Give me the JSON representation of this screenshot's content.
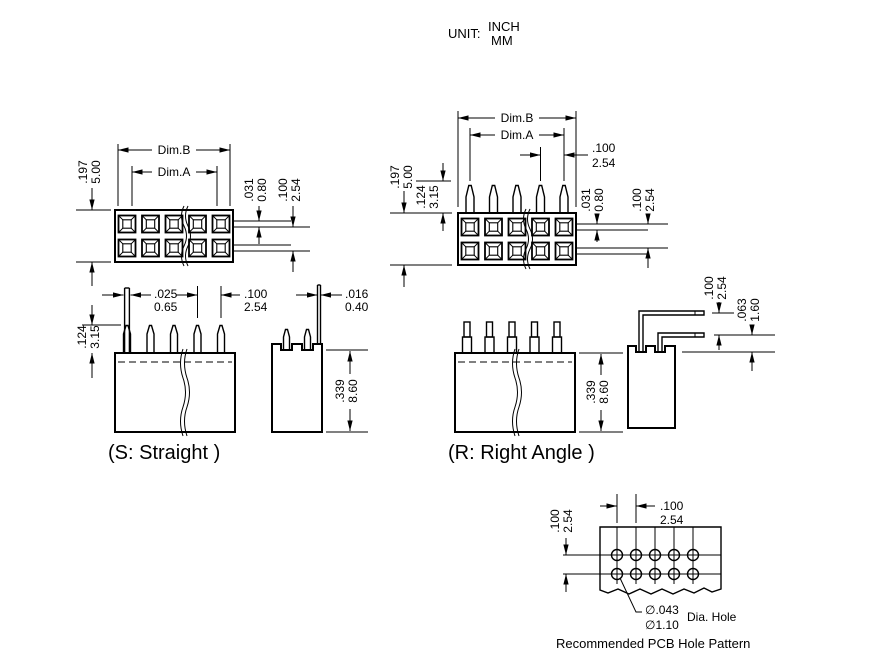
{
  "unit": {
    "label": "UNIT:",
    "inch": "INCH",
    "mm": "MM"
  },
  "dims": {
    "dimB": "Dim.B",
    "dimA": "Dim.A",
    "d197": {
      "inch": ".197",
      "mm": "5.00"
    },
    "d124": {
      "inch": ".124",
      "mm": "3.15"
    },
    "d031": {
      "inch": ".031",
      "mm": "0.80"
    },
    "d100": {
      "inch": ".100",
      "mm": "2.54"
    },
    "d025": {
      "inch": ".025",
      "mm": "0.65"
    },
    "d016": {
      "inch": ".016",
      "mm": "0.40"
    },
    "d339": {
      "inch": ".339",
      "mm": "8.60"
    },
    "d063": {
      "inch": ".063",
      "mm": "1.60"
    },
    "d043": {
      "inch": "∅.043",
      "mm": "∅1.10"
    }
  },
  "captions": {
    "straight": "(S: Straight )",
    "right_angle": "(R: Right Angle )",
    "dia_hole": "Dia. Hole",
    "pcb_pattern": "Recommended PCB Hole Pattern"
  }
}
